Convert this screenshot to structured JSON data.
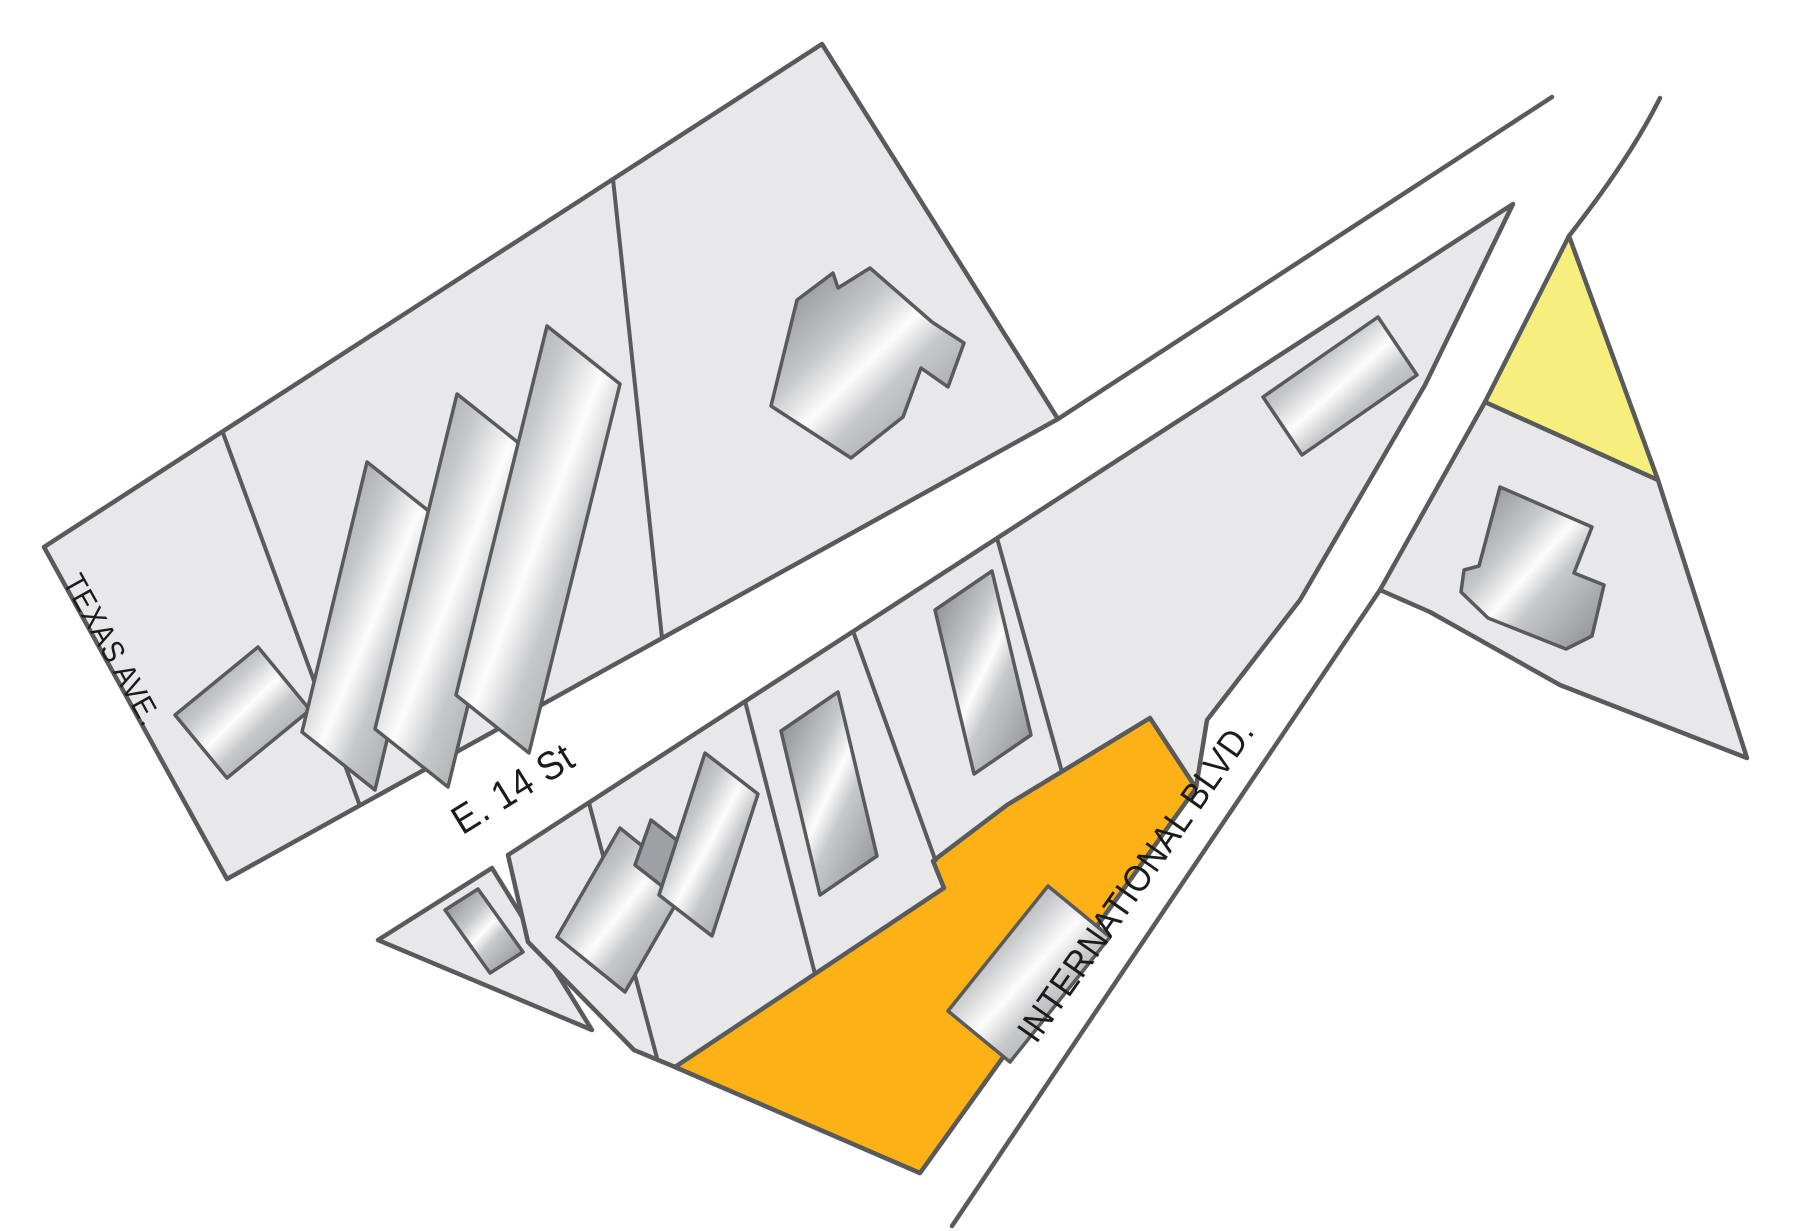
{
  "map": {
    "title": "parcel-site-map",
    "streets": {
      "texas_ave": "TEXAS AVE.",
      "e_14": "E. 14 St",
      "international": "INTERNATIONAL BLVD."
    },
    "colors": {
      "background": "#FFFFFF",
      "parcel": "#E8E8EA",
      "outline": "#595A5C",
      "highlight_orange": "#FCB216",
      "highlight_yellow": "#F7EF7D",
      "building_dark": "#7F8083",
      "building_mid": "#C7C8CA",
      "building_light": "#FDFDFD",
      "building_shade": "#8A8B8E",
      "annex_gray": "#9EA0A3",
      "label_color": "#1B1B1B"
    }
  }
}
